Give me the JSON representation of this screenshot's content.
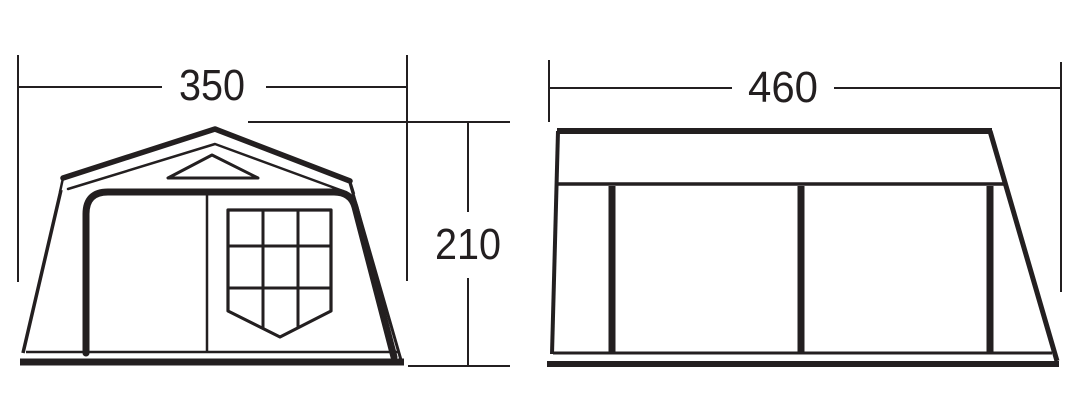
{
  "colors": {
    "line": "#231f20",
    "background": "#ffffff"
  },
  "diagram": {
    "subject": "tent dimension drawing",
    "front_view": {
      "width_label": "350",
      "height_label": "210"
    },
    "side_view": {
      "width_label": "460"
    }
  }
}
